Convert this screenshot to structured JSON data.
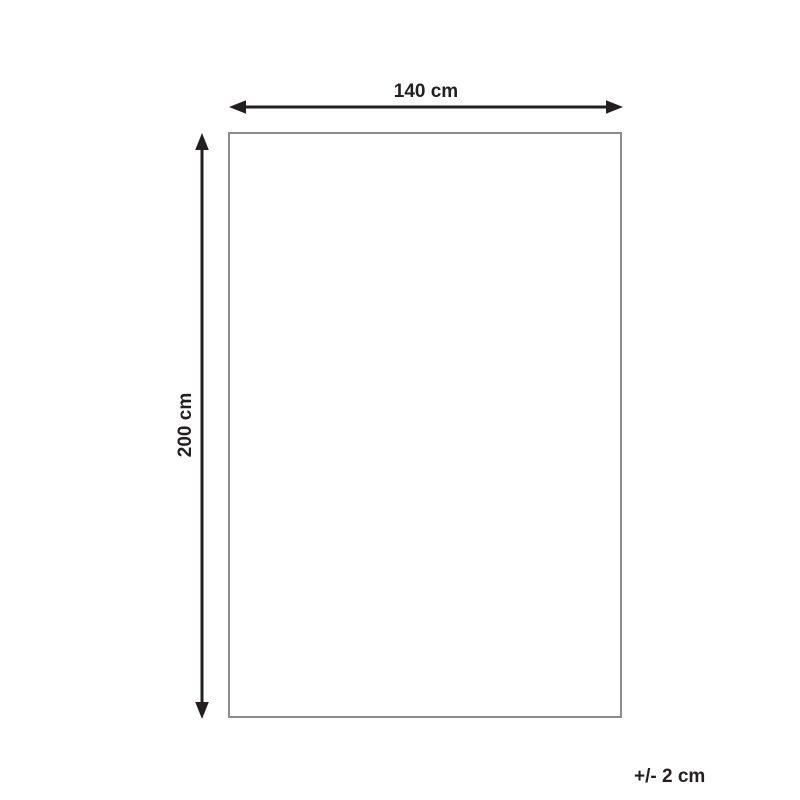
{
  "diagram": {
    "title": "product-dimension-diagram",
    "width_label": "140 cm",
    "height_label": "200 cm",
    "tolerance_label": "+/- 2 cm"
  },
  "colors": {
    "arrow": "#231f20",
    "text": "#231f20",
    "outline": "#8c8c8e",
    "background": "#ffffff"
  }
}
